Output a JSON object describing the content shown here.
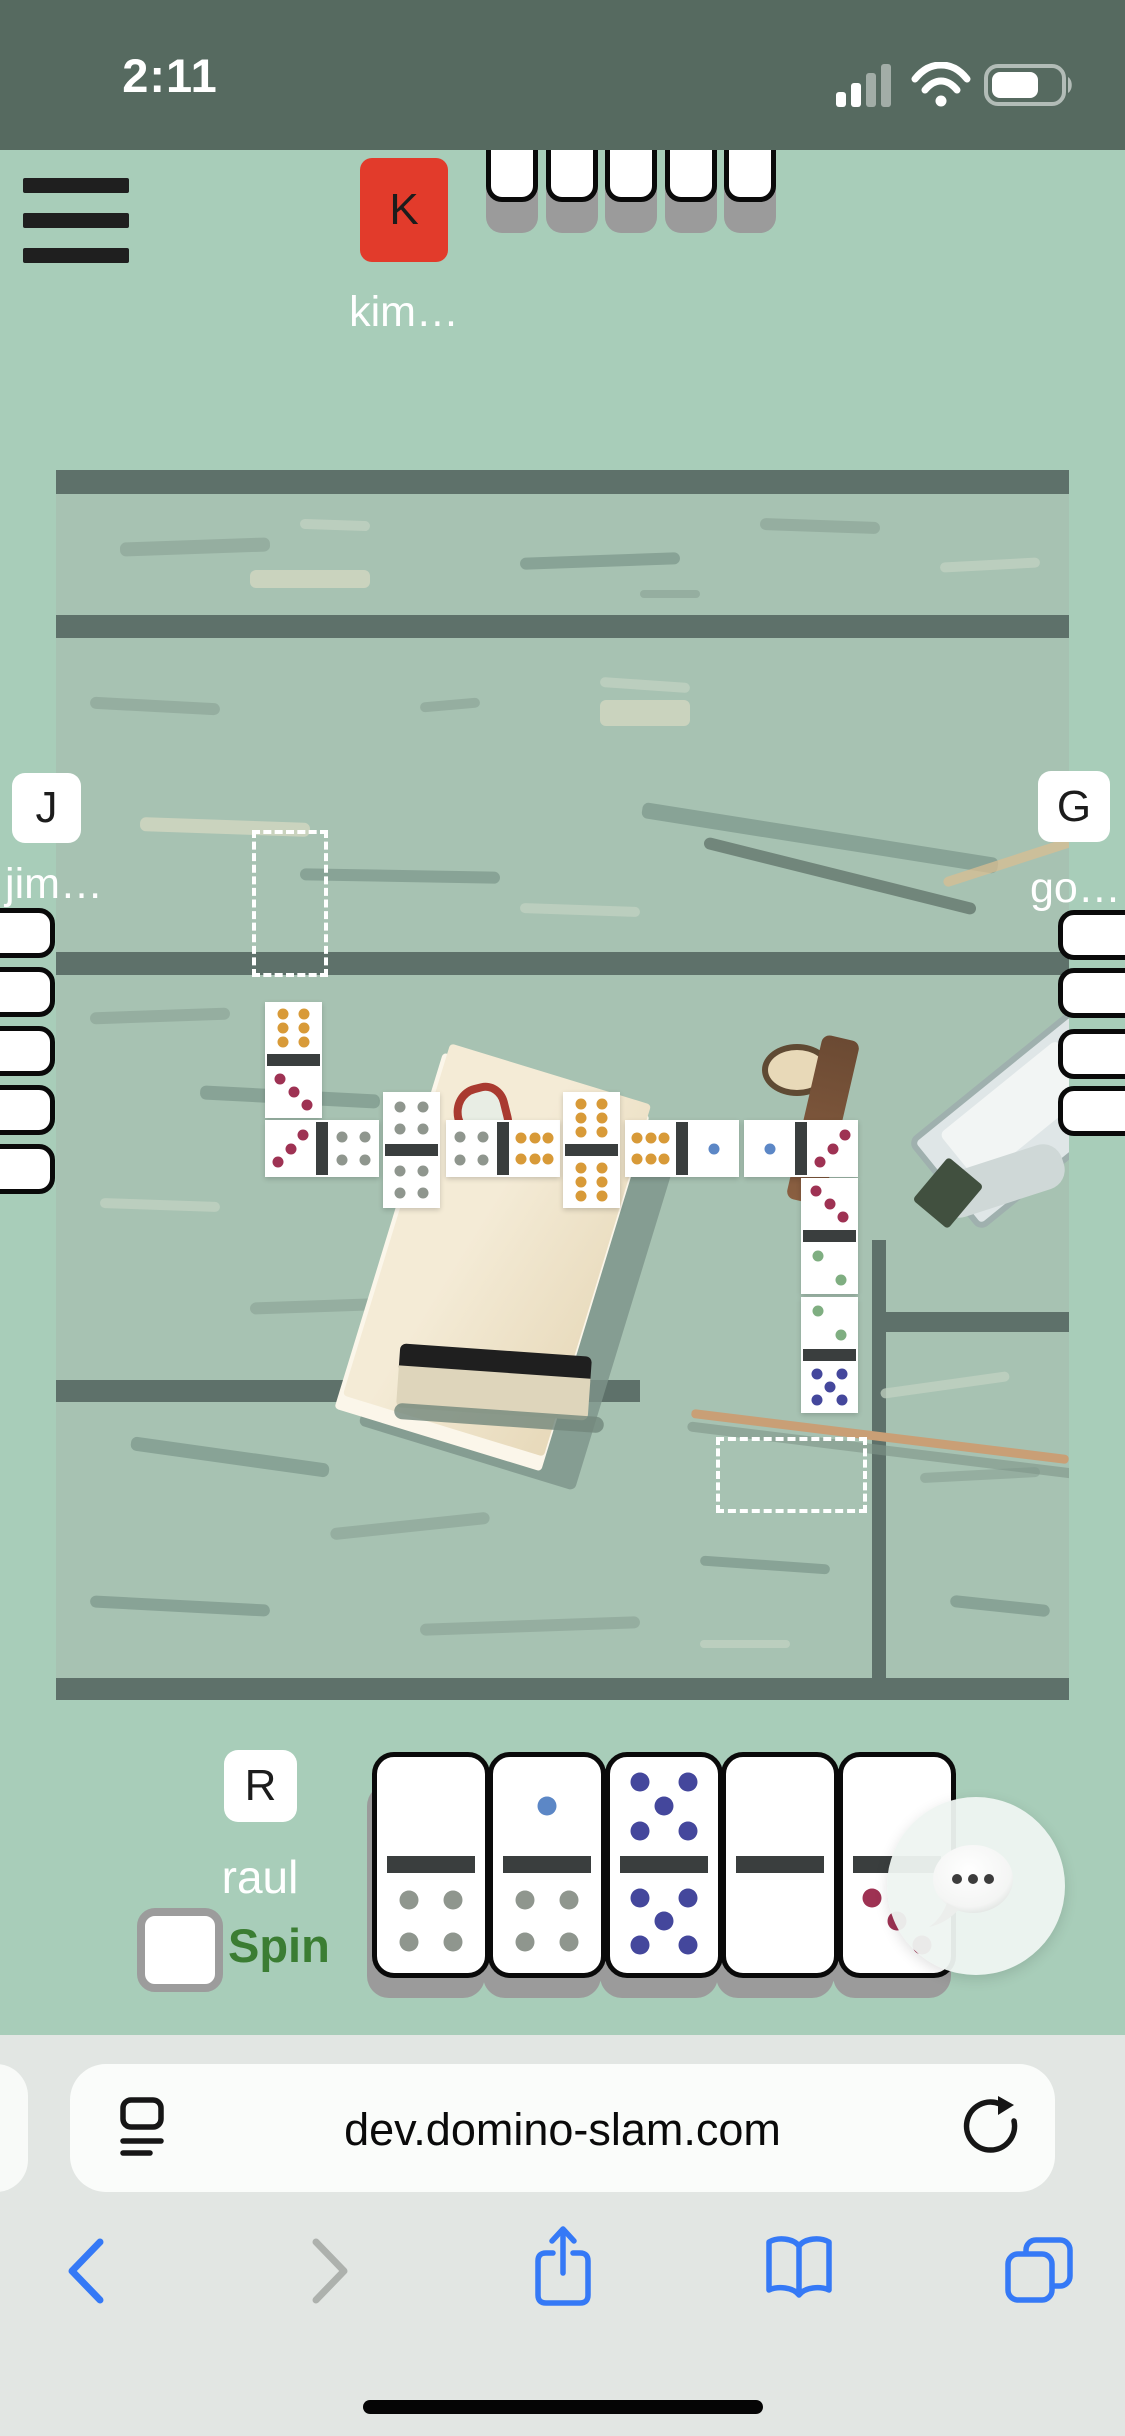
{
  "status_bar": {
    "time": "2:11",
    "signal_bars_active": 2,
    "signal_bars_total": 4,
    "battery_fill": 0.7
  },
  "menu": {
    "label": "hamburger-menu"
  },
  "players": {
    "top": {
      "initial": "K",
      "name": "kim…",
      "avatar_color": "#e23b2b",
      "hidden_tiles": 5
    },
    "left": {
      "initial": "J",
      "name": "jim…",
      "hidden_tiles": 5
    },
    "right": {
      "initial": "G",
      "name": "go…",
      "hidden_tiles": 4
    },
    "bottom": {
      "initial": "R",
      "name": "raul"
    }
  },
  "spin": {
    "label": "Spin",
    "checked": false
  },
  "board": {
    "dominoes": [
      {
        "x": 265,
        "y": 1002,
        "orient": "v",
        "a": 6,
        "b": 3
      },
      {
        "x": 265,
        "y": 1120,
        "orient": "h",
        "a": 3,
        "b": 4
      },
      {
        "x": 383,
        "y": 1092,
        "orient": "v",
        "a": 4,
        "b": 4
      },
      {
        "x": 446,
        "y": 1120,
        "orient": "h",
        "a": 4,
        "b": 6
      },
      {
        "x": 563,
        "y": 1092,
        "orient": "v",
        "a": 6,
        "b": 6
      },
      {
        "x": 625,
        "y": 1120,
        "orient": "h",
        "a": 6,
        "b": 1
      },
      {
        "x": 744,
        "y": 1120,
        "orient": "h",
        "a": 1,
        "b": 3
      },
      {
        "x": 801,
        "y": 1178,
        "orient": "v",
        "a": 3,
        "b": 2
      },
      {
        "x": 801,
        "y": 1297,
        "orient": "v",
        "a": 2,
        "b": 5
      }
    ],
    "drop_zones": [
      {
        "x": 252,
        "y": 830,
        "w": 76,
        "h": 147
      },
      {
        "x": 716,
        "y": 1437,
        "w": 151,
        "h": 76
      }
    ]
  },
  "hand": {
    "tiles": [
      {
        "a": 0,
        "b": 4
      },
      {
        "a": 1,
        "b": 4
      },
      {
        "a": 5,
        "b": 5
      },
      {
        "a": 0,
        "b": 0
      },
      {
        "a": 0,
        "b": 3
      }
    ]
  },
  "pip_colors": {
    "1": "#5c87c6",
    "2": "#7fae81",
    "3": "#9e3253",
    "4": "#8f968e",
    "5": "#44479c",
    "6": "#d89a38"
  },
  "chat": {
    "icon": "speech-bubble"
  },
  "browser": {
    "url": "dev.domino-slam.com",
    "icons": {
      "reader": "page-format-icon",
      "reload": "reload-icon",
      "back": "chevron-left",
      "forward": "chevron-right",
      "share": "share-icon",
      "bookmarks": "book-icon",
      "tabs": "tabs-icon"
    }
  },
  "colors": {
    "status_bar_bg": "#566a60",
    "page_bg": "#a8cdb9",
    "spin_green": "#3b7d33",
    "safari_blue": "#3579f6"
  }
}
